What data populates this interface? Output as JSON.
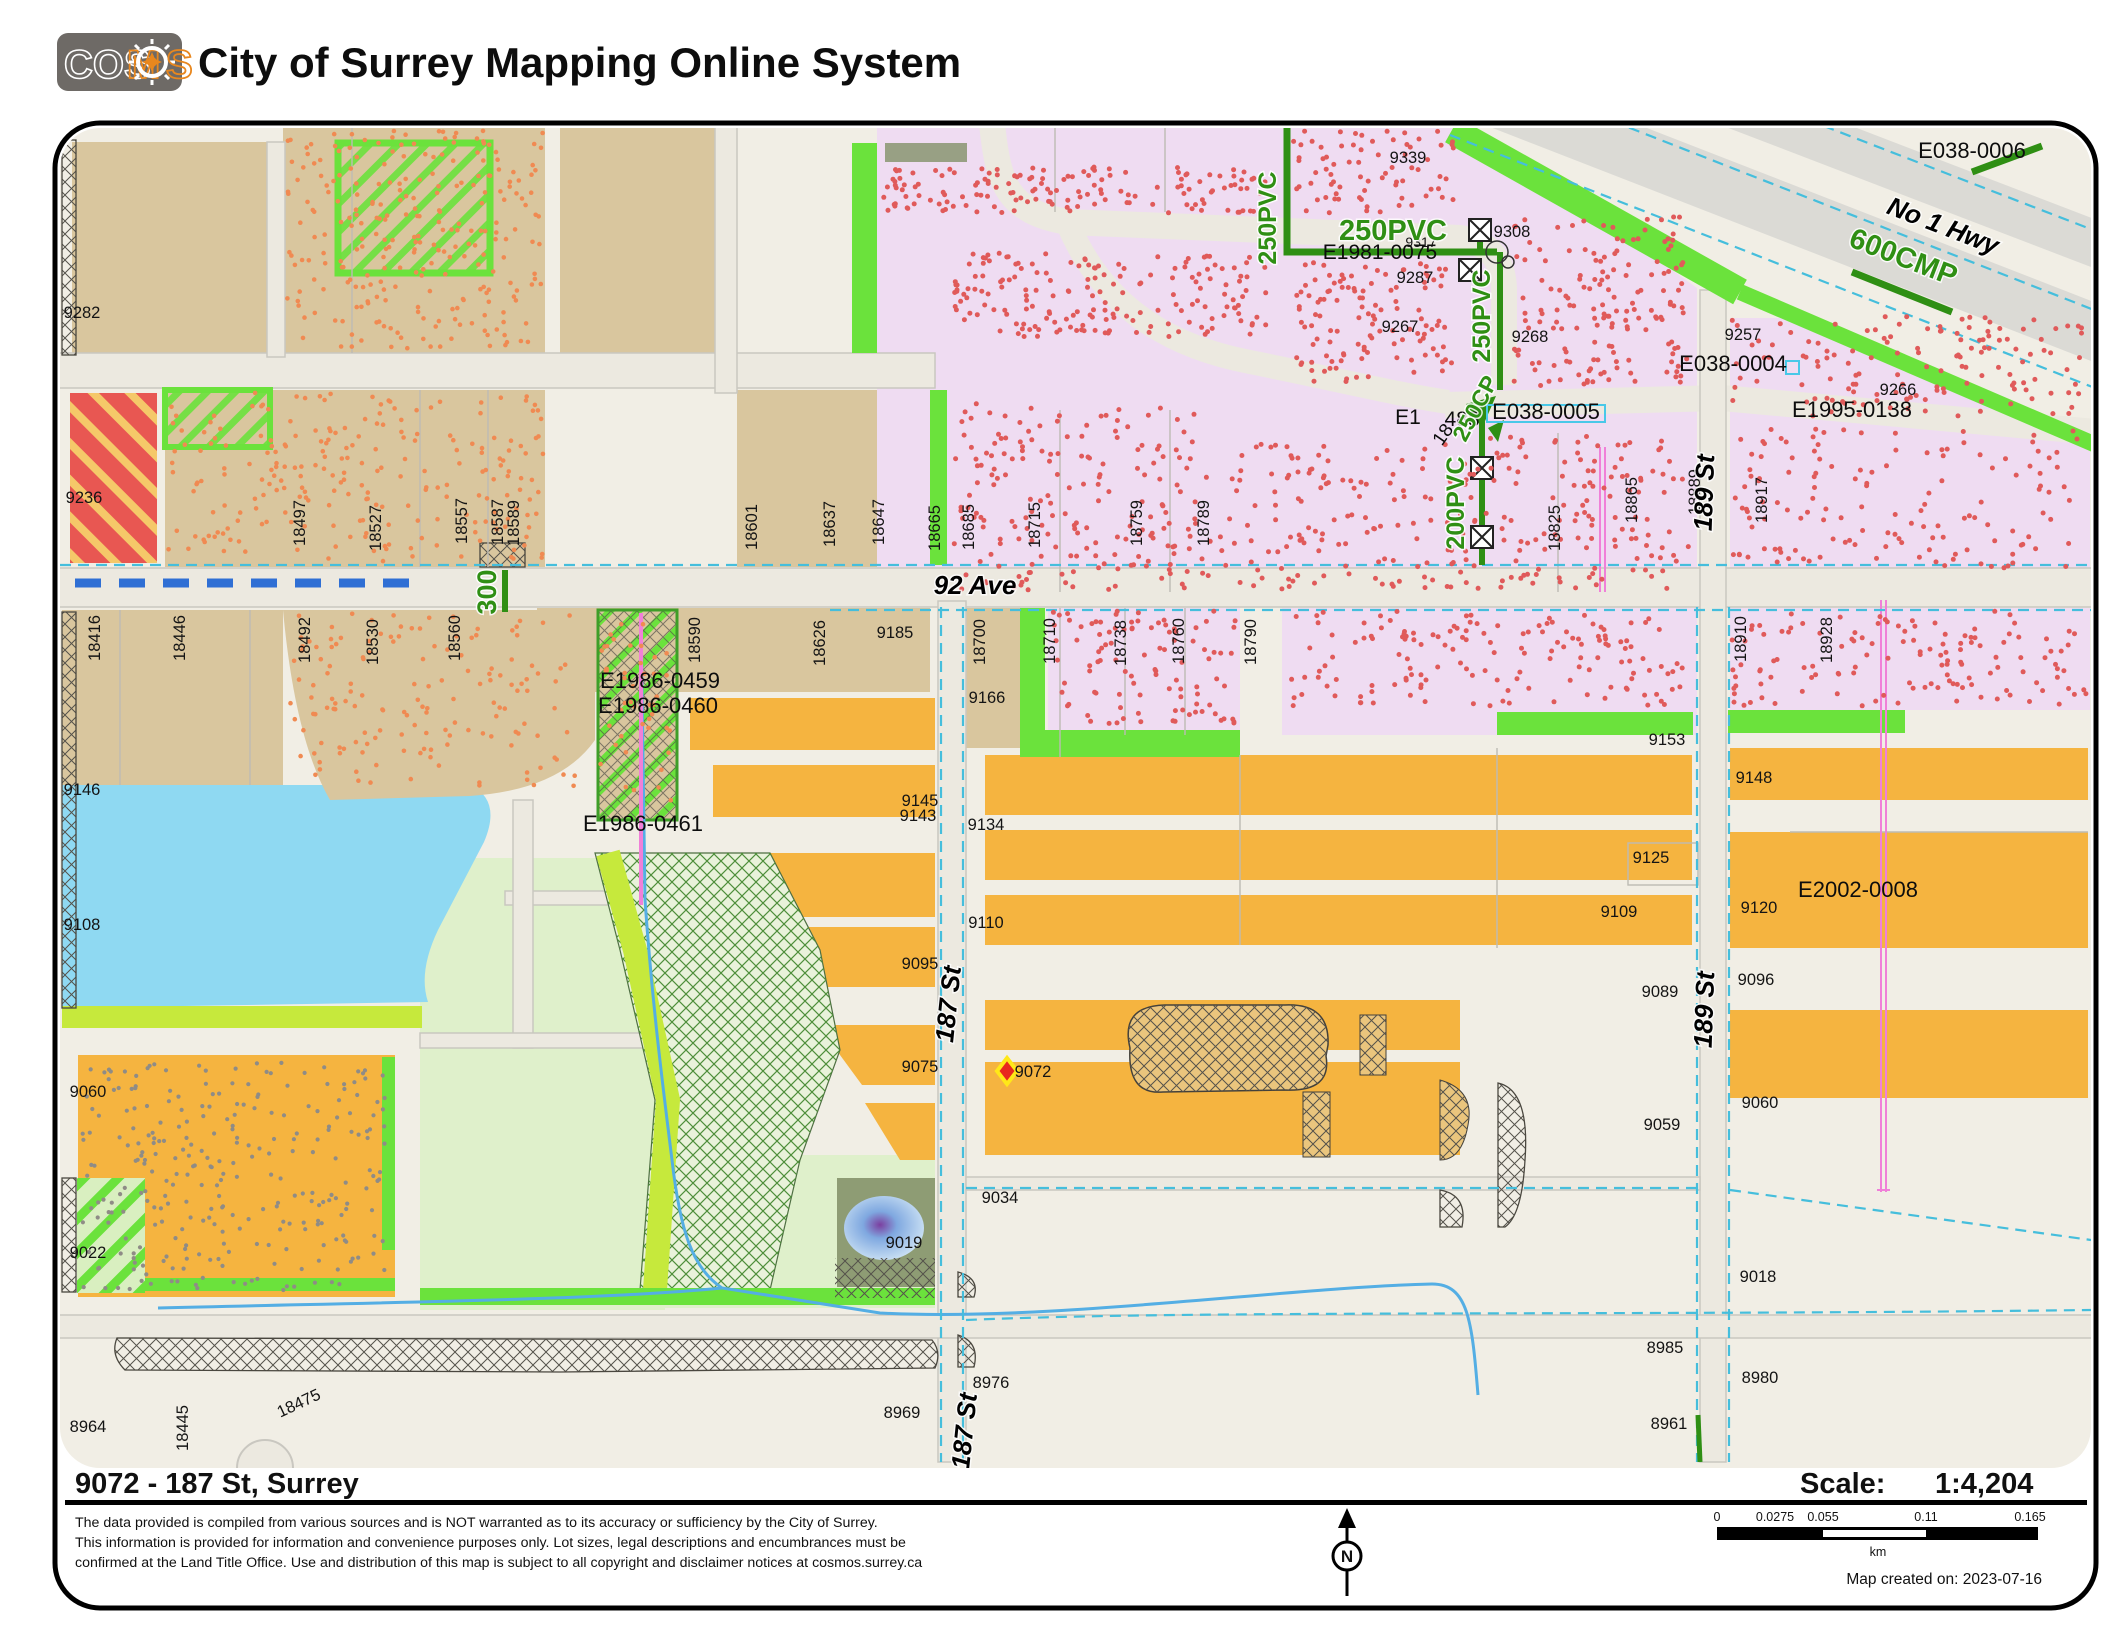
{
  "header": {
    "logo_parts": {
      "cos": "COS",
      "m": "M",
      "s": "S"
    },
    "title": "City of Surrey Mapping Online System"
  },
  "footer": {
    "address_title": "9072 - 187 St, Surrey",
    "scale_label": "Scale:",
    "scale_value": "1:4,204",
    "disclaimer_lines": [
      "The data provided is compiled from various sources and is NOT warranted as to its accuracy or sufficiency by the City of Surrey.",
      "This information is provided for information and convenience purposes only.  Lot sizes, legal descriptions and encumbrances must be",
      "confirmed at the Land Title Office.  Use and distribution of this map is subject to all copyright and disclaimer notices at cosmos.surrey.ca"
    ],
    "north_label": "N",
    "scalebar": {
      "ticks": [
        "0",
        "0.0275",
        "0.055",
        "0.11",
        "0.165"
      ],
      "unit": "km"
    },
    "created_label": "Map created on: 2023-07-16"
  },
  "palette": {
    "accent_orange_logo": "#E8871E",
    "pipe_green": "#2F8F14",
    "subject_marker_fill": "#E8281E",
    "subject_marker_stroke": "#FFE818",
    "water_blue": "#8FD9F2",
    "parcel_orange": "#F5B440",
    "parcel_pink": "#EFDCF2",
    "parcel_tan": "#D9C69E"
  },
  "map": {
    "street_labels": [
      [
        "92 Ave",
        975,
        594,
        0,
        26
      ],
      [
        "187 St",
        957,
        1005,
        -84,
        26
      ],
      [
        "187 St",
        973,
        1432,
        -84,
        26
      ],
      [
        "189 St",
        1713,
        493,
        -88,
        26
      ],
      [
        "189 St",
        1713,
        1010,
        -88,
        26
      ],
      [
        "No 1 Hwy",
        1940,
        234,
        21,
        26
      ]
    ],
    "parcel_labels": [
      [
        "9282",
        82,
        318
      ],
      [
        "9236",
        84,
        503
      ],
      [
        "18497",
        305,
        523,
        -90
      ],
      [
        "18527",
        381,
        528,
        -90
      ],
      [
        "18557",
        467,
        521,
        -90
      ],
      [
        "18587",
        503,
        522,
        -90
      ],
      [
        "18589",
        519,
        523,
        -90
      ],
      [
        "18601",
        757,
        527,
        -90
      ],
      [
        "18637",
        835,
        524,
        -90
      ],
      [
        "18647",
        884,
        522,
        -90
      ],
      [
        "18665",
        940,
        528,
        -90
      ],
      [
        "18685",
        974,
        527,
        -90
      ],
      [
        "18715",
        1040,
        525,
        -90
      ],
      [
        "18759",
        1142,
        523,
        -90
      ],
      [
        "18789",
        1209,
        523,
        -90
      ],
      [
        "9339",
        1408,
        163
      ],
      [
        "9308",
        1512,
        237
      ],
      [
        "9287",
        1415,
        283
      ],
      [
        "9268",
        1530,
        342
      ],
      [
        "9267",
        1400,
        332
      ],
      [
        "9257",
        1743,
        340
      ],
      [
        "9317",
        1421,
        247,
        0,
        14
      ],
      [
        "9266",
        1898,
        395
      ],
      [
        "18825",
        1560,
        528,
        -90
      ],
      [
        "18865",
        1637,
        500,
        -90
      ],
      [
        "18889",
        1700,
        492,
        -90
      ],
      [
        "18917",
        1767,
        500,
        -90
      ],
      [
        "18416",
        100,
        638,
        -90
      ],
      [
        "18446",
        185,
        638,
        -90
      ],
      [
        "18492",
        310,
        640,
        -90
      ],
      [
        "18530",
        378,
        642,
        -90
      ],
      [
        "18560",
        460,
        638,
        -90
      ],
      [
        "18590",
        700,
        640,
        -90
      ],
      [
        "18626",
        825,
        643,
        -90
      ],
      [
        "9185",
        895,
        638
      ],
      [
        "18700",
        985,
        642,
        -90
      ],
      [
        "9166",
        987,
        703
      ],
      [
        "18710",
        1055,
        641,
        -90
      ],
      [
        "18738",
        1126,
        643,
        -90
      ],
      [
        "18760",
        1184,
        641,
        -90
      ],
      [
        "18790",
        1256,
        642,
        -90
      ],
      [
        "18910",
        1746,
        639,
        -90
      ],
      [
        "18928",
        1832,
        640,
        -90
      ],
      [
        "9146",
        82,
        795
      ],
      [
        "9108",
        82,
        930
      ],
      [
        "9153",
        1667,
        745
      ],
      [
        "9148",
        1754,
        783
      ],
      [
        "9145",
        920,
        806
      ],
      [
        "9143",
        918,
        821
      ],
      [
        "9134",
        986,
        830
      ],
      [
        "9125",
        1651,
        863
      ],
      [
        "9110",
        986,
        928
      ],
      [
        "9109",
        1619,
        917
      ],
      [
        "9120",
        1759,
        913
      ],
      [
        "9095",
        920,
        969
      ],
      [
        "9096",
        1756,
        985
      ],
      [
        "9089",
        1660,
        997
      ],
      [
        "9075",
        920,
        1072
      ],
      [
        "9072",
        1033,
        1077
      ],
      [
        "9060",
        88,
        1097
      ],
      [
        "9059",
        1662,
        1130
      ],
      [
        "9060",
        1760,
        1108
      ],
      [
        "9034",
        1000,
        1203
      ],
      [
        "9022",
        88,
        1258
      ],
      [
        "9019",
        904,
        1248
      ],
      [
        "9018",
        1758,
        1282
      ],
      [
        "8985",
        1665,
        1353
      ],
      [
        "8980",
        1760,
        1383
      ],
      [
        "8976",
        991,
        1388
      ],
      [
        "8964",
        88,
        1432
      ],
      [
        "8969",
        902,
        1418
      ],
      [
        "8961",
        1669,
        1429
      ],
      [
        "18445",
        188,
        1428,
        -90
      ],
      [
        "18475",
        301,
        1408,
        -25
      ]
    ],
    "enumber_labels": [
      [
        "E1986-0459",
        660,
        688
      ],
      [
        "E1986-0460",
        658,
        713
      ],
      [
        "E1986-0461",
        643,
        831
      ],
      [
        "E038-0004",
        1733,
        371
      ],
      [
        "E038-0005",
        1546,
        419
      ],
      [
        "E1995-0138",
        1852,
        417
      ],
      [
        "E2002-0008",
        1858,
        897
      ],
      [
        "E038-0006",
        1972,
        158
      ],
      [
        "E1981-0075",
        1380,
        259,
        0,
        21
      ],
      [
        "E1",
        1408,
        424,
        0,
        21
      ],
      [
        "488",
        1462,
        426,
        0,
        21
      ],
      [
        "18",
        1448,
        438,
        -55,
        19
      ]
    ],
    "pipe_labels": [
      [
        "250PVC",
        1276,
        218,
        -90,
        25
      ],
      [
        "250PVC",
        1393,
        240,
        0,
        29
      ],
      [
        "250PVC",
        1490,
        316,
        -90,
        25
      ],
      [
        "250CP",
        1482,
        412,
        -62,
        23
      ],
      [
        "200PVC",
        1464,
        503,
        -90,
        25
      ],
      [
        "600CMP",
        1900,
        266,
        21,
        29
      ],
      [
        "300",
        496,
        592,
        -90,
        27
      ]
    ],
    "dot_regions": [
      [
        287,
        130,
        543,
        350,
        260,
        "o"
      ],
      [
        168,
        392,
        543,
        562,
        230,
        "o"
      ],
      [
        287,
        613,
        578,
        788,
        150,
        "o"
      ],
      [
        600,
        618,
        672,
        808,
        45,
        "o"
      ],
      [
        882,
        167,
        1266,
        213,
        150,
        "r"
      ],
      [
        954,
        253,
        1266,
        337,
        180,
        "r"
      ],
      [
        1295,
        262,
        1452,
        382,
        120,
        "r"
      ],
      [
        1292,
        131,
        1455,
        214,
        75,
        "r"
      ],
      [
        1512,
        216,
        1686,
        330,
        110,
        "r"
      ],
      [
        1512,
        342,
        1690,
        386,
        50,
        "r"
      ],
      [
        954,
        403,
        1196,
        590,
        190,
        "r"
      ],
      [
        1200,
        443,
        1436,
        590,
        120,
        "r"
      ],
      [
        1443,
        433,
        1690,
        590,
        150,
        "r"
      ],
      [
        1732,
        316,
        2082,
        417,
        140,
        "r"
      ],
      [
        1732,
        428,
        2082,
        568,
        140,
        "r"
      ],
      [
        1050,
        611,
        1236,
        724,
        100,
        "r"
      ],
      [
        1284,
        611,
        1690,
        706,
        150,
        "r"
      ],
      [
        1732,
        611,
        2086,
        706,
        130,
        "r"
      ],
      [
        82,
        1060,
        386,
        1290,
        280,
        "g"
      ]
    ],
    "subject_marker": {
      "x": 1007,
      "y": 1071,
      "label": "9072"
    }
  }
}
